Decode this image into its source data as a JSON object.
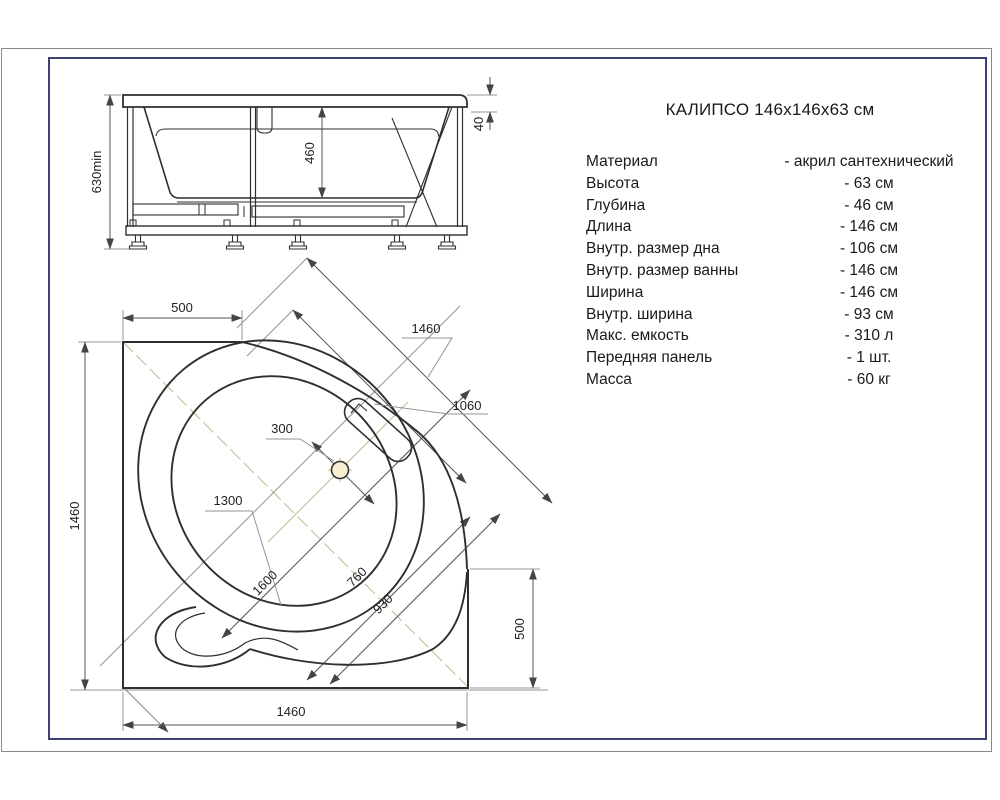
{
  "title": "КАЛИПСО 146х146х63 см",
  "specs": {
    "rows": [
      {
        "label": "Материал",
        "value": "- акрил сантехнический"
      },
      {
        "label": "Высота",
        "value": "- 63 см"
      },
      {
        "label": "Глубина",
        "value": "- 46 см"
      },
      {
        "label": "Длина",
        "value": "- 146 см"
      },
      {
        "label": "Внутр. размер дна",
        "value": "- 106 см"
      },
      {
        "label": "Внутр. размер ванны",
        "value": "- 146 см"
      },
      {
        "label": "Ширина",
        "value": "- 146 см"
      },
      {
        "label": "Внутр. ширина",
        "value": "- 93 см"
      },
      {
        "label": "Макс. емкость",
        "value": "- 310 л"
      },
      {
        "label": "Передняя панель",
        "value": "- 1 шт."
      },
      {
        "label": "Масса",
        "value": "- 60 кг"
      }
    ]
  },
  "elevation": {
    "dims": {
      "overall_height": "630min",
      "inner_depth": "460",
      "rim_height": "40"
    }
  },
  "plan": {
    "dims": {
      "top_offset": "500",
      "left_side": "1460",
      "bottom_side": "1460",
      "right_offset": "500",
      "diagonal_width": "1460",
      "headrest": "1060",
      "drain_offset": "300",
      "bowl_width": "1300",
      "diagonal_length": "1600",
      "inner_width_1": "760",
      "inner_width_2": "930"
    }
  },
  "colors": {
    "frame_blue": "#3d4273",
    "border_gray": "#8a8a8a",
    "line_dark": "#2f2f2f",
    "centerline_olive": "#c9c39b"
  }
}
